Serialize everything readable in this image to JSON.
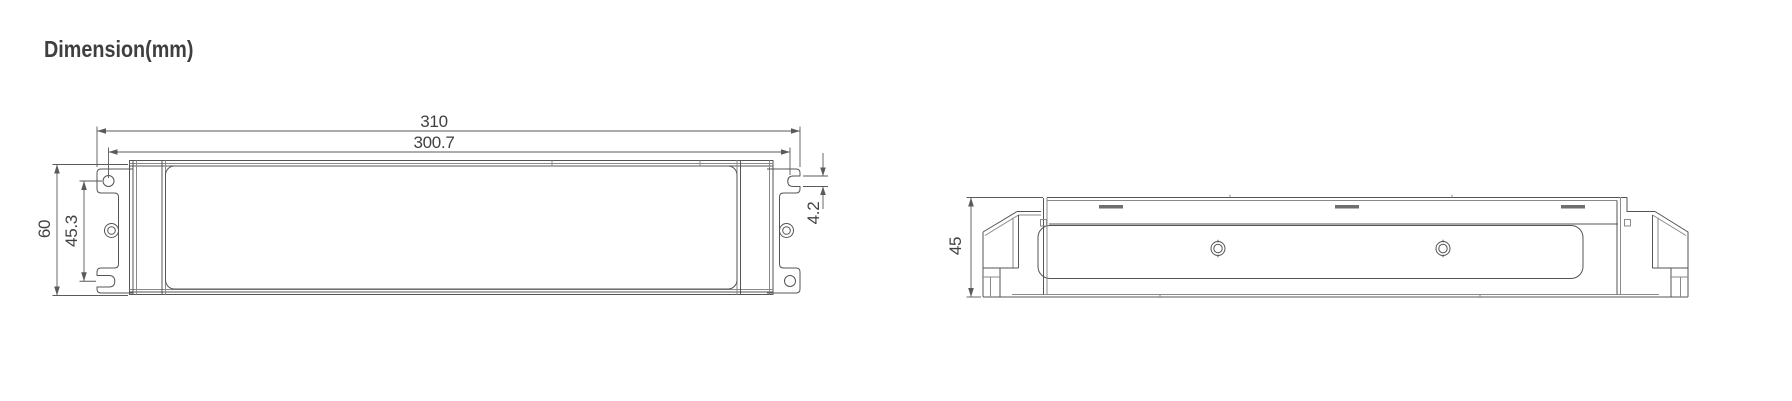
{
  "title": "Dimension(mm)",
  "views": {
    "front": {
      "label": "front-view",
      "dims": {
        "overall_length": "310",
        "mount_length": "300.7",
        "overall_height": "60",
        "mount_height": "45.3",
        "slot_width": "4.2"
      }
    },
    "side": {
      "label": "side-view",
      "dims": {
        "height": "45"
      }
    }
  },
  "colors": {
    "background": "#ffffff",
    "line": "#545454",
    "seam_line": "#8a8a8a",
    "text": "#414141"
  }
}
